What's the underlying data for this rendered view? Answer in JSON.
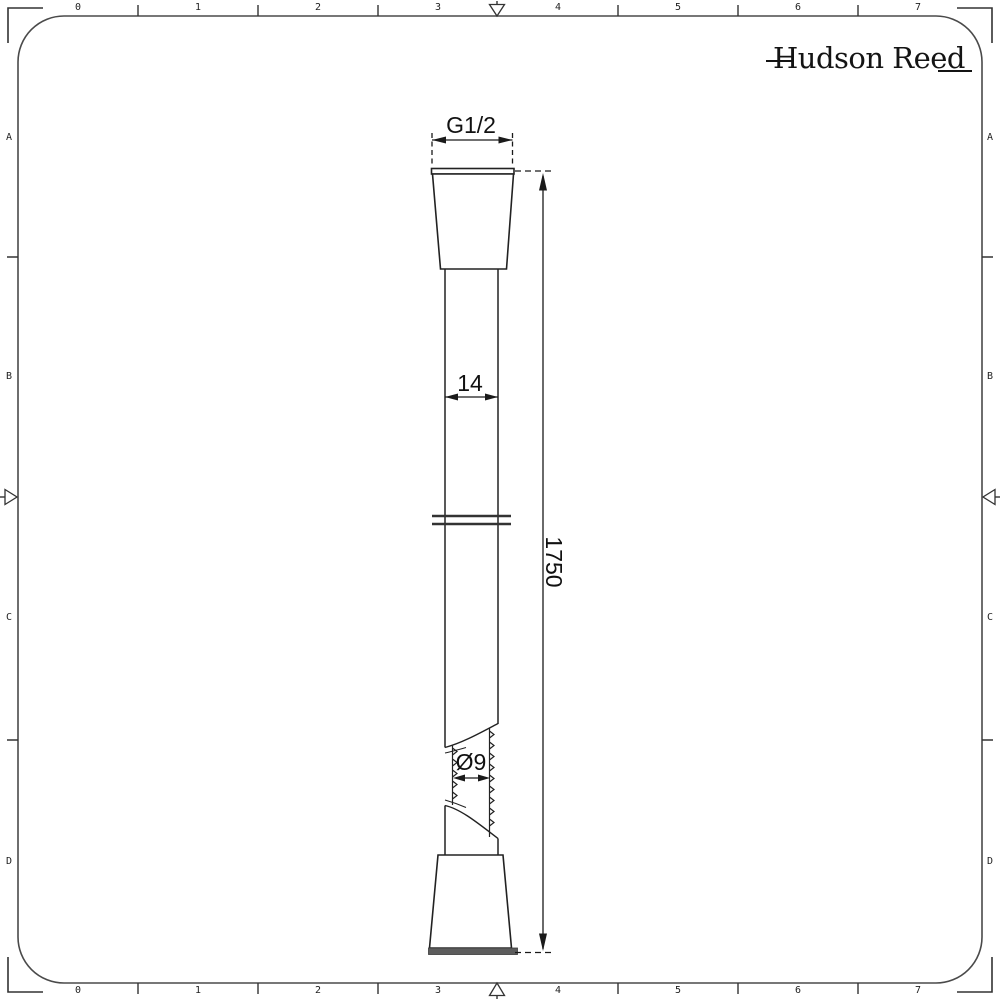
{
  "brand": {
    "name": "Hudson Reed"
  },
  "drawing_labels": {
    "thread_size": "G1/2",
    "hose_outer_diameter": "14",
    "hose_length": "1750",
    "hose_inner_diameter": "Ø9"
  },
  "ruler": {
    "top": [
      "0",
      "1",
      "2",
      "3",
      "4",
      "5",
      "6",
      "7"
    ],
    "bottom": [
      "0",
      "1",
      "2",
      "3",
      "4",
      "5",
      "6",
      "7"
    ],
    "left": [
      "A",
      "B",
      "C",
      "D"
    ],
    "right": [
      "A",
      "B",
      "C",
      "D"
    ]
  },
  "colors": {
    "background": "#ffffff",
    "drawing_line": "#222222",
    "frame_line": "#4a4a4a",
    "connector_base_band": "#5c5c5c"
  }
}
